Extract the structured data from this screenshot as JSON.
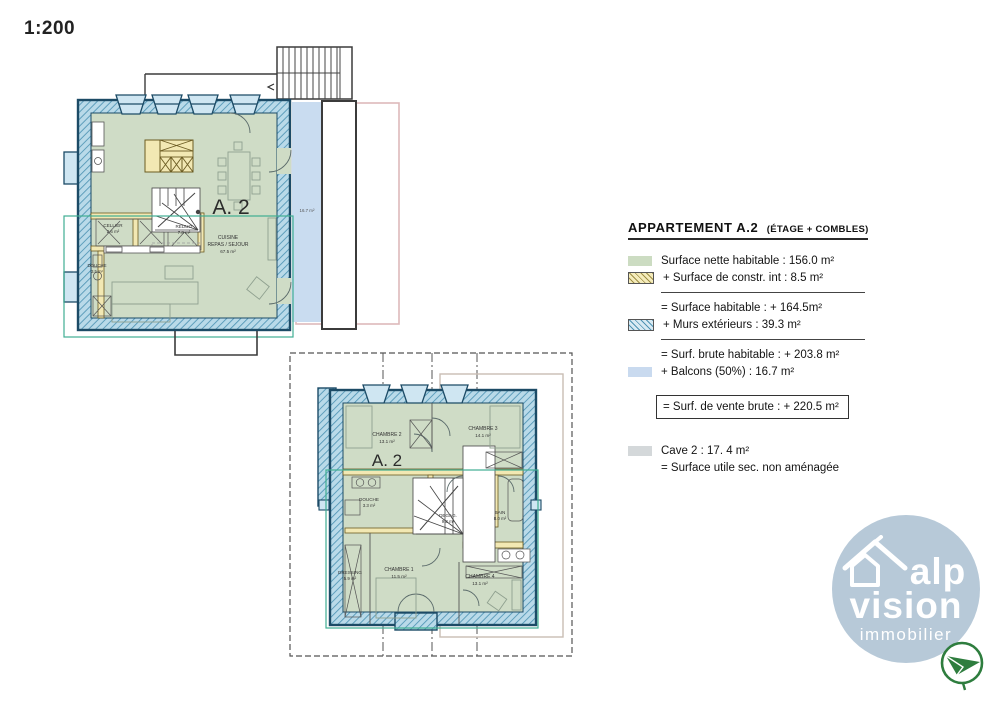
{
  "scale_label": "1:200",
  "colors": {
    "wall_fill": "#b9dae9",
    "wall_hatch_line": "#4f94b4",
    "wall_stroke": "#1c4b66",
    "interior_green": "#cfdcc6",
    "interior_wall_yellow": "#f2e8b3",
    "balcony_blue": "#c9dcf0",
    "neighbour_outline_pink": "#ddb9ba",
    "net_surface_outline_teal": "#3fae92",
    "cave_dash_gray": "#555555",
    "logo_circle": "#b7c9d8",
    "logo_plane_green": "#2e7d3e"
  },
  "floor1": {
    "unit_label": "A. 2",
    "balcony_area": "16.7 m²",
    "rooms": [
      {
        "name": "CELLIER",
        "area": "2.6 m²"
      },
      {
        "name": "RÉDUIT",
        "area": "7.8 m²"
      },
      {
        "name": "CUISINE",
        "name2": "REPAS / SEJOUR",
        "area": "67.5 m²"
      },
      {
        "name": "DOUCHE",
        "area": "3.5 m²"
      }
    ]
  },
  "floor2": {
    "unit_label": "A. 2",
    "rooms": [
      {
        "name": "CHAMBRE  2",
        "area": "13.1 m²"
      },
      {
        "name": "CHAMBRE  3",
        "area": "14.1 m²"
      },
      {
        "name": "DOUCHE",
        "area": "3.3 m²"
      },
      {
        "name": "DEGAG.",
        "area": "9.3 m²"
      },
      {
        "name": "BAIN",
        "area": "8.0 m²"
      },
      {
        "name": "DRESSING",
        "area": "5.9 m²"
      },
      {
        "name": "CHAMBRE  1",
        "area": "11.5 m²"
      },
      {
        "name": "CHAMBRE  4",
        "area": "13.1 m²"
      }
    ]
  },
  "legend": {
    "title": "APPARTEMENT  A.2",
    "title_suffix": "(ÉTAGE + COMBLES)",
    "rows": [
      {
        "swatch": "green",
        "text": "Surface nette habitable : 156.0 m²"
      },
      {
        "swatch": "yellowhatch",
        "text": "+ Surface de constr. int : 8.5 m²"
      },
      {
        "swatch": "none",
        "text": "= Surface  habitable : + 164.5m²"
      },
      {
        "swatch": "bluehatch",
        "text": "+ Murs extérieurs : 39.3 m²"
      },
      {
        "swatch": "none",
        "text": "= Surf. brute habitable : + 203.8 m²"
      },
      {
        "swatch": "blue",
        "text": "+ Balcons (50%) : 16.7 m²"
      },
      {
        "swatch": "none",
        "text": "= Surf. de  vente brute : + 220.5 m²"
      },
      {
        "swatch": "gray",
        "text": "Cave 2 : 17. 4 m²"
      },
      {
        "swatch": "none",
        "text": "= Surface  utile sec. non aménagée"
      }
    ]
  },
  "logo": {
    "line1": "alp",
    "line2": "vision",
    "line3": "immobilier"
  }
}
